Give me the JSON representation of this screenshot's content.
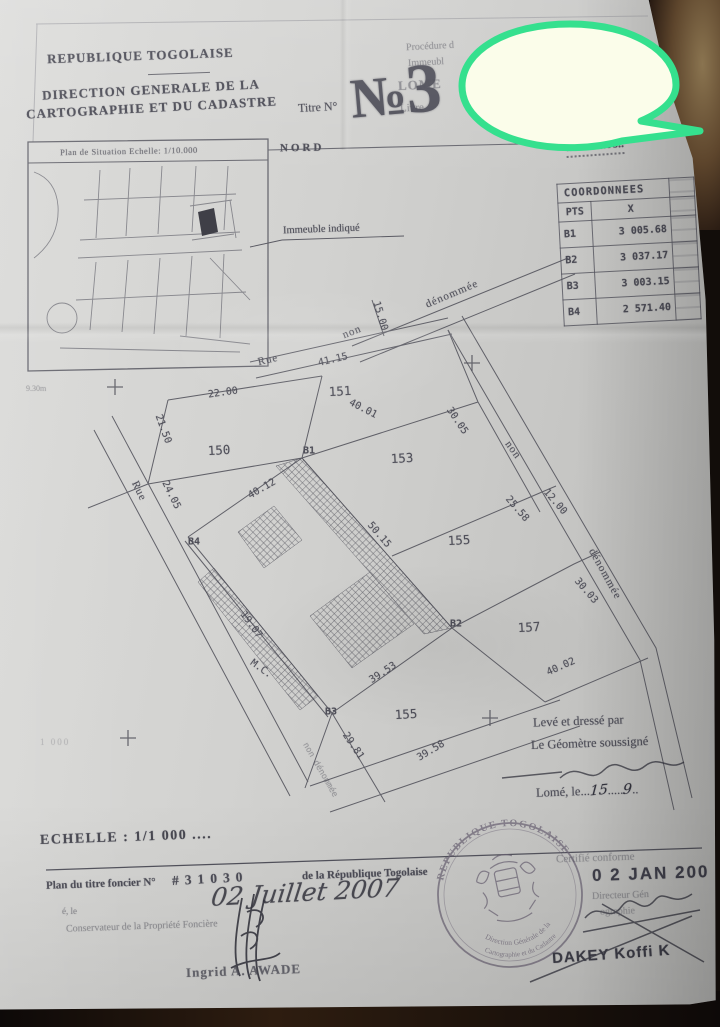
{
  "scene": {
    "bubble_fill": "#fbfdea",
    "bubble_stroke": "#35e08e",
    "paper_color": "#cfcfcd",
    "backdrop_color": "#120d0a",
    "ink_color": "#4d4d57"
  },
  "header": {
    "republic": "REPUBLIQUE TOGOLAISE",
    "direction_line1": "DIRECTION GENERALE DE LA",
    "direction_line2": "CARTOGRAPHIE ET DU CADASTRE",
    "titre_label": "Titre N°",
    "numero_sign": "№",
    "numero_value": "3",
    "procedure_fragment": "Procédure d",
    "immeuble_fragment": "Immeubl",
    "lome_fragment": "LOME",
    "livre_fragment": "Livre",
    "right_fragment_1": "L18",
    "right_fragment_2": "cha",
    "right_fragment_3": "lai",
    "ref_dotted": "..42. &..08.."
  },
  "situation_map": {
    "title": "Plan de Situation Echelle: 1/10.000",
    "annotation": "Immeuble indiqué",
    "faint_measure": "9.30m"
  },
  "plan": {
    "nord": "NORD",
    "labels": {
      "rue_top": "Rue",
      "non_top": "non",
      "denommee_top": "dénommée",
      "m_15_00": "15.00",
      "m_41_15": "41.15",
      "m_22_00": "22.00",
      "m_21_50": "21.50",
      "p_150": "150",
      "p_151": "151",
      "p_153": "153",
      "b1": "B1",
      "m_40_01": "40.01",
      "m_30_05": "30.05",
      "rue_left": "Rue",
      "m_24_05": "24.05",
      "b4": "B4",
      "m_40_12": "40.12",
      "m_50_15": "50.15",
      "non_right": "non",
      "m_25_58": "25.58",
      "m_12_00": "12.00",
      "denommee_right": "dénommée",
      "p_155": "155",
      "m_30_03": "30.03",
      "m_19_07": "19.07",
      "mc": "M.C.",
      "m_39_53": "39.53",
      "b3": "B3",
      "b2": "B2",
      "p_157": "157",
      "m_40_02": "40.02",
      "p_155b": "155",
      "m_29_81": "29.81",
      "m_39_58": "39.58",
      "non_den_bottom": "non dénommée"
    }
  },
  "coord_table": {
    "title": "COORDONNEES",
    "col_pts": "PTS",
    "col_x": "X",
    "rows": [
      {
        "pt": "B1",
        "x": "3 005.68"
      },
      {
        "pt": "B2",
        "x": "3 037.17"
      },
      {
        "pt": "B3",
        "x": "3 003.15"
      },
      {
        "pt": "B4",
        "x": "2 571.40"
      }
    ]
  },
  "surveyor": {
    "line1": "Levé et dressé par",
    "line2": "Le Géomètre soussigné",
    "lome_le": "Lomé, le",
    "dots1": "...",
    "day": "15",
    "dots2": ".....",
    "month": "9",
    "dots3": ".."
  },
  "scale_block": {
    "echelle": "ECHELLE : 1/1 000 ....",
    "faint_text": "1 000"
  },
  "footer": {
    "title_prefix": "Plan du titre foncier N°",
    "title_number": "#31030",
    "title_suffix": "de la République Togolaise",
    "date_hand": "02 Juillet 2007",
    "le_label": "é, le",
    "conservateur": "Conservateur de la Propriété Foncière",
    "signatory_name": "Ingrid A. AWADE"
  },
  "stamp": {
    "arc_top": "REPUBLIQUE TOGOLAISE",
    "arc_bottom_1": "Direction Générale de la",
    "arc_bottom_2": "Cartographie et du Cadastre"
  },
  "certification": {
    "certifie": "Certifié conforme",
    "date_stamp": "0 2 JAN 200",
    "directeur": "Directeur Gén",
    "ographie": "ographie",
    "name": "DAKEY Koffi K"
  }
}
